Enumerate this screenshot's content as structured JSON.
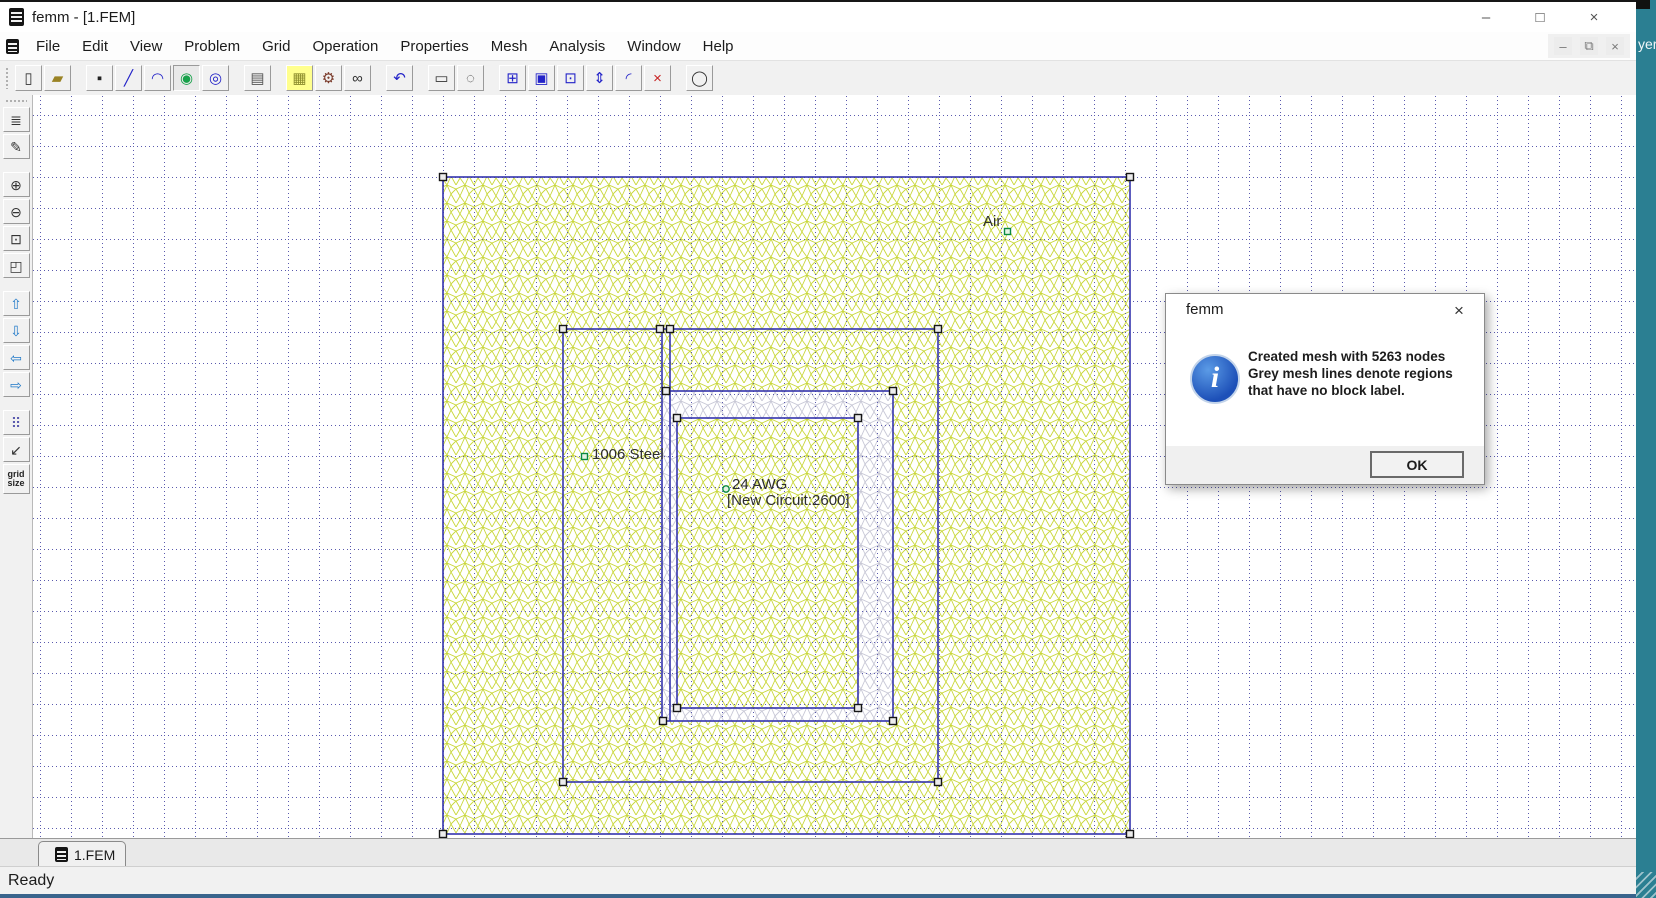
{
  "window": {
    "title": "femm - [1.FEM]",
    "controls": [
      {
        "name": "minimize-button",
        "icon": "minimize-icon",
        "glyph": "–"
      },
      {
        "name": "maximize-button",
        "icon": "maximize-icon",
        "glyph": "□"
      },
      {
        "name": "close-button",
        "icon": "close-icon",
        "glyph": "×"
      }
    ]
  },
  "menu": {
    "items": [
      "File",
      "Edit",
      "View",
      "Problem",
      "Grid",
      "Operation",
      "Properties",
      "Mesh",
      "Analysis",
      "Window",
      "Help"
    ]
  },
  "mdi_controls": [
    {
      "name": "mdi-minimize-button",
      "icon": "minimize-icon",
      "glyph": "–"
    },
    {
      "name": "mdi-restore-button",
      "icon": "restore-icon",
      "glyph": "⧉"
    },
    {
      "name": "mdi-close-button",
      "icon": "close-icon",
      "glyph": "×"
    }
  ],
  "toolbar": {
    "buttons": [
      {
        "name": "new-file-button",
        "icon": "new-file-icon",
        "glyph": "▯",
        "color": "#333333"
      },
      {
        "name": "open-file-button",
        "icon": "open-folder-icon",
        "glyph": "▰",
        "color": "#9a8325"
      },
      {
        "name": "point-tool-button",
        "icon": "node-point-icon",
        "glyph": "▪",
        "color": "#222222",
        "gap": true
      },
      {
        "name": "line-tool-button",
        "icon": "line-segment-icon",
        "glyph": "╱",
        "color": "#2323c8"
      },
      {
        "name": "arc-tool-button",
        "icon": "arc-segment-icon",
        "glyph": "◠",
        "color": "#2323c8"
      },
      {
        "name": "block-label-tool-button",
        "icon": "block-label-icon",
        "glyph": "◉",
        "color": "#17a14a",
        "active": true
      },
      {
        "name": "group-tool-button",
        "icon": "group-select-icon",
        "glyph": "◎",
        "color": "#2323c8"
      },
      {
        "name": "properties-button",
        "icon": "properties-icon",
        "glyph": "▤",
        "color": "#555555",
        "gap": true
      },
      {
        "name": "mesh-button",
        "icon": "mesh-grid-icon",
        "glyph": "▦",
        "color": "#8a8a2a",
        "highlight": true,
        "gap": true
      },
      {
        "name": "run-analysis-button",
        "icon": "crank-gear-icon",
        "glyph": "⚙",
        "color": "#7a3a2a"
      },
      {
        "name": "view-results-button",
        "icon": "glasses-icon",
        "glyph": "∞",
        "color": "#333333"
      },
      {
        "name": "undo-button",
        "icon": "undo-arrow-icon",
        "glyph": "↶",
        "color": "#2323c8",
        "gap": true
      },
      {
        "name": "select-rect-button",
        "icon": "dashed-rect-icon",
        "glyph": "▭",
        "color": "#333333",
        "gap": true
      },
      {
        "name": "select-circle-button",
        "icon": "dashed-circle-icon",
        "glyph": "◌",
        "color": "#333333"
      },
      {
        "name": "move-button",
        "icon": "move-icon",
        "glyph": "⊞",
        "color": "#2323c8",
        "gap": true
      },
      {
        "name": "copy-button",
        "icon": "copy-icon",
        "glyph": "▣",
        "color": "#2323c8"
      },
      {
        "name": "edit-group-button",
        "icon": "edit-group-icon",
        "glyph": "⊡",
        "color": "#2323c8"
      },
      {
        "name": "flip-button",
        "icon": "flip-icon",
        "glyph": "⇕",
        "color": "#2323c8"
      },
      {
        "name": "fillet-button",
        "icon": "fillet-corner-icon",
        "glyph": "◜",
        "color": "#2323c8"
      },
      {
        "name": "delete-button",
        "icon": "delete-x-icon",
        "glyph": "×",
        "color": "#c82323"
      },
      {
        "name": "circle-view-button",
        "icon": "circle-icon",
        "glyph": "◯",
        "color": "#333333",
        "gap": true
      }
    ]
  },
  "sidebar": {
    "buttons": [
      {
        "name": "import-button",
        "icon": "doc-list-icon",
        "glyph": "≣",
        "color": "#333333"
      },
      {
        "name": "edit-doc-button",
        "icon": "doc-edit-icon",
        "glyph": "✎",
        "color": "#333333"
      },
      {
        "name": "zoom-in-button",
        "icon": "zoom-in-icon",
        "glyph": "⊕",
        "color": "#333333",
        "gap": true
      },
      {
        "name": "zoom-out-button",
        "icon": "zoom-out-icon",
        "glyph": "⊖",
        "color": "#333333"
      },
      {
        "name": "zoom-extents-button",
        "icon": "zoom-page-icon",
        "glyph": "⊡",
        "color": "#333333"
      },
      {
        "name": "zoom-window-button",
        "icon": "zoom-window-icon",
        "glyph": "◰",
        "color": "#333333"
      },
      {
        "name": "pan-up-button",
        "icon": "up-arrow-icon",
        "glyph": "⇧",
        "color": "#1e78c8",
        "gap": true
      },
      {
        "name": "pan-down-button",
        "icon": "down-arrow-icon",
        "glyph": "⇩",
        "color": "#1e78c8"
      },
      {
        "name": "pan-left-button",
        "icon": "left-arrow-icon",
        "glyph": "⇦",
        "color": "#1e78c8"
      },
      {
        "name": "pan-right-button",
        "icon": "right-arrow-icon",
        "glyph": "⇨",
        "color": "#1e78c8"
      },
      {
        "name": "show-grid-button",
        "icon": "grid-dots-icon",
        "glyph": "⠿",
        "color": "#5a5aae",
        "gap": true
      },
      {
        "name": "snap-grid-button",
        "icon": "snap-arrow-icon",
        "glyph": "↙",
        "color": "#333333"
      },
      {
        "name": "grid-size-button",
        "icon": "grid-size-label",
        "glyph": "grid\nsize",
        "color": "#222222",
        "text": true
      }
    ]
  },
  "canvas": {
    "labels": [
      {
        "name": "air-region-label",
        "text": "Air",
        "x": 983,
        "y": 213
      },
      {
        "name": "steel-region-label",
        "text": "1006 Steel",
        "x": 592,
        "y": 446
      },
      {
        "name": "coil-region-label",
        "text": "24 AWG",
        "x": 732,
        "y": 476
      },
      {
        "name": "coil-circuit-label",
        "text": "[New Circuit:2600]",
        "x": 727,
        "y": 492
      }
    ],
    "colors": {
      "mesh_yellow": "#c9d73b",
      "mesh_grey": "#c8c8d6",
      "boundary_blue": "#3434ad",
      "grid_dot": "#5a5aae",
      "label_node_green": "#0a8a40"
    }
  },
  "dialog": {
    "title": "femm",
    "close_glyph": "×",
    "lines": [
      "Created mesh with 5263 nodes",
      "Grey mesh lines denote regions",
      "that have no block label."
    ],
    "ok_label": "OK"
  },
  "tabbar": {
    "tabs": [
      {
        "label": "1.FEM"
      }
    ]
  },
  "statusbar": {
    "text": "Ready"
  },
  "side_window": {
    "text": "yer"
  }
}
